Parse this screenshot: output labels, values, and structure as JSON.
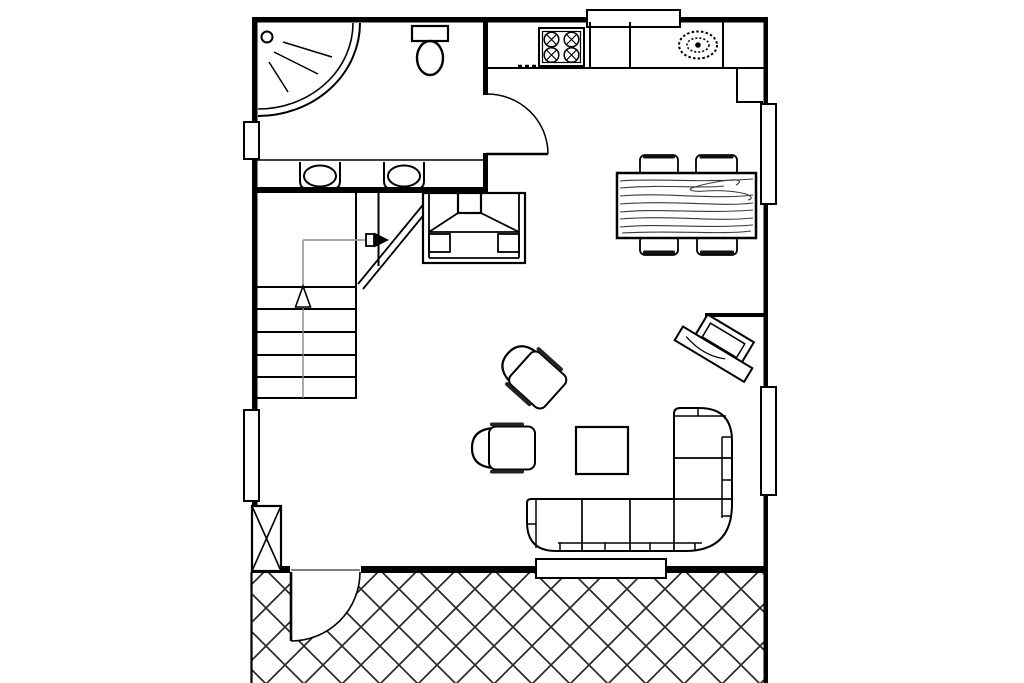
{
  "page": {
    "title": "",
    "background": "#ffffff"
  },
  "plan": {
    "type": "floor-plan",
    "line_color": "#000000",
    "wood_grain_color": "#3a3a3a",
    "walking_line_color": "#8a8a8a",
    "hatch_color": "#2a2a2a",
    "window_fill": "#ffffff",
    "areas": [
      {
        "name": "bathroom",
        "fixtures": [
          "corner-shower",
          "shower-head-spray",
          "toilet",
          "washbasin",
          "washbasin",
          "vanity-counter"
        ]
      },
      {
        "name": "kitchen",
        "fixtures": [
          "counter-run",
          "four-burner-stove",
          "oval-sink",
          "counter-return",
          "under-counter-appliance-marks",
          "swing-door"
        ]
      },
      {
        "name": "dining-area",
        "fixtures": [
          "wood-grain-table",
          "chair",
          "chair",
          "chair",
          "chair"
        ]
      },
      {
        "name": "stairwell",
        "fixtures": [
          "stair-treads",
          "walking-line-arrow",
          "up-arrow",
          "break-line"
        ]
      },
      {
        "name": "living-area",
        "fixtures": [
          "fireplace",
          "armchair-rotated",
          "armchair",
          "coffee-table",
          "l-shaped-sofa",
          "tv-on-console",
          "partial-wall"
        ]
      },
      {
        "name": "patio",
        "fixtures": [
          "crosshatch-paving",
          "swing-door",
          "chimney-column"
        ]
      }
    ],
    "openings": {
      "windows": 6,
      "doors": 2
    }
  }
}
